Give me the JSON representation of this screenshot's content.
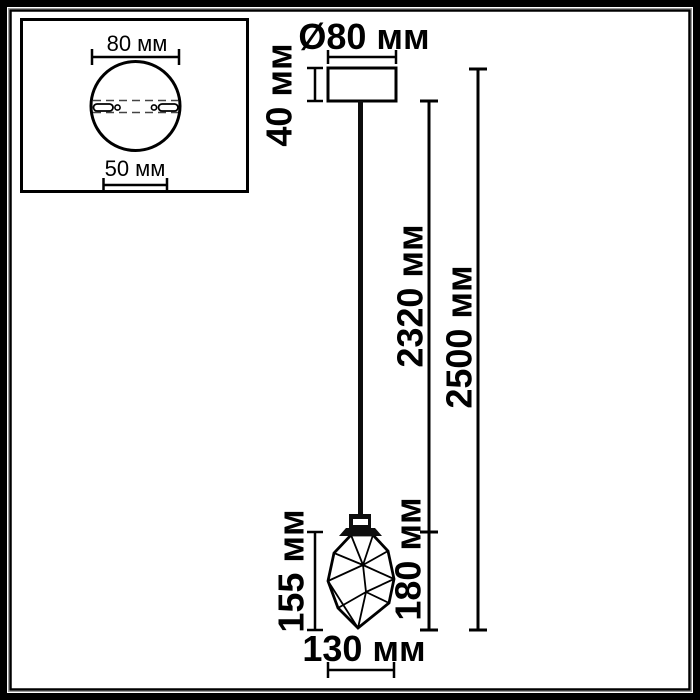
{
  "colors": {
    "line": "#000000",
    "background": "#ffffff",
    "frame_inner_accent": "#999999"
  },
  "mount_top_view": {
    "plate_diameter": "80 мм",
    "hole_spacing": "50 мм"
  },
  "dimensions": {
    "canopy_diameter": "Ø80 мм",
    "canopy_height": "40 мм",
    "cord_length": "2320 мм",
    "overall_height": "2500 мм",
    "shade_with_socket_height": "180 мм",
    "shade_height": "155 мм",
    "shade_width": "130 мм"
  }
}
